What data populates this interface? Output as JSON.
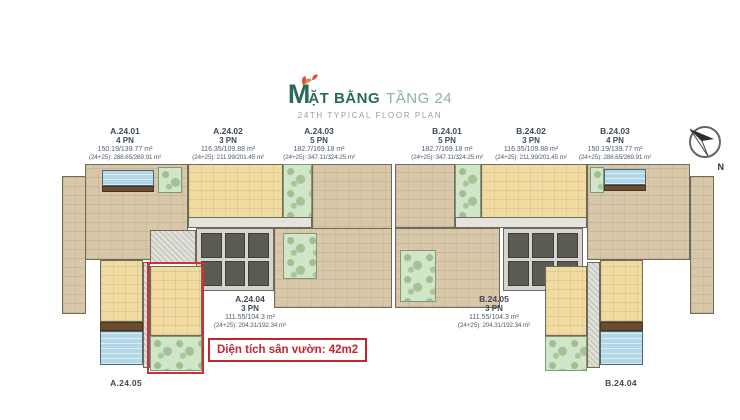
{
  "header": {
    "logo_letter": "M",
    "title_rest": "ẶT BẰNG",
    "title_accent": "TẦNG 24",
    "subtitle": "24TH TYPICAL FLOOR PLAN"
  },
  "compass": {
    "north_label": "N"
  },
  "unit_labels": [
    {
      "id": "A.24.01",
      "bedrooms": "4 PN",
      "area": "150.19/139.77 m²",
      "area_combined": "(24+25): 288.65/269.91 m²"
    },
    {
      "id": "A.24.02",
      "bedrooms": "3 PN",
      "area": "116.35/109.88 m²",
      "area_combined": "(24+25): 211.99/201.45 m²"
    },
    {
      "id": "A.24.03",
      "bedrooms": "5 PN",
      "area": "182.7/169.18 m²",
      "area_combined": "(24+25): 347.11/324.25 m²"
    },
    {
      "id": "B.24.01",
      "bedrooms": "5 PN",
      "area": "182.7/169.18 m²",
      "area_combined": "(24+25): 347.11/324.25 m²"
    },
    {
      "id": "B.24.02",
      "bedrooms": "3 PN",
      "area": "116.35/109.88 m²",
      "area_combined": "(24+25): 211.99/201.45 m²"
    },
    {
      "id": "B.24.03",
      "bedrooms": "4 PN",
      "area": "150.19/139.77 m²",
      "area_combined": "(24+25): 288.65/269.91 m²"
    },
    {
      "id": "A.24.04",
      "bedrooms": "3 PN",
      "area": "111.55/104.3 m²",
      "area_combined": "(24+25): 204.31/192.34 m²"
    },
    {
      "id": "B.24.05",
      "bedrooms": "3 PN",
      "area": "111.55/104.3 m²",
      "area_combined": "(24+25): 204.31/192.34 m²"
    }
  ],
  "corner_unit_labels": {
    "bottom_left": "A.24.05",
    "bottom_right": "B.24.04"
  },
  "annotation": {
    "garden_area_note": "Diện tích sân vườn: 42m2"
  },
  "colors": {
    "brand_green": "#2a6b58",
    "accent_green": "#8fb39e",
    "highlight_red": "#c0272d",
    "room_tan": "#d9c7a9",
    "room_yellow": "#f2dba0",
    "garden_green": "#d3e5c8",
    "pool_blue": "#b4d7e8",
    "deck_brown": "#6b4c31"
  }
}
